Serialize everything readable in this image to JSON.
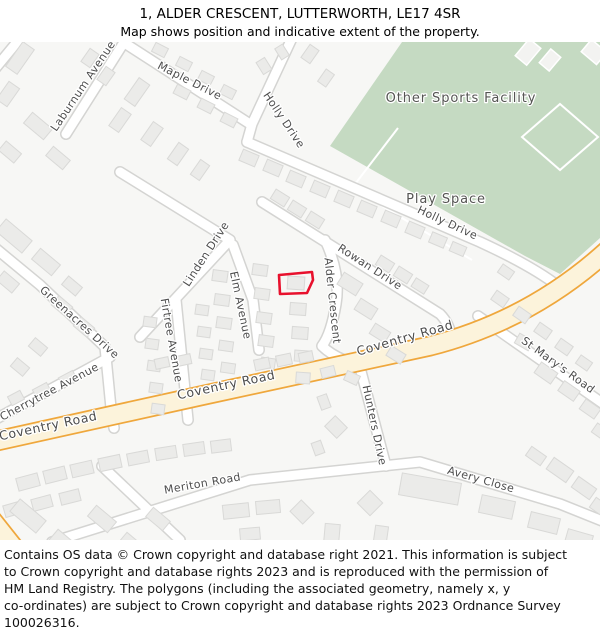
{
  "header": {
    "title": "1, ALDER CRESCENT, LUTTERWORTH, LE17 4SR",
    "subtitle": "Map shows position and indicative extent of the property."
  },
  "map": {
    "area_labels": {
      "sports_facility": "Other Sports Facility",
      "play_space": "Play Space"
    },
    "street_labels": {
      "laburnum": "Laburnum Avenue",
      "maple": "Maple Drive",
      "holly_top": "Holly Drive",
      "holly_se": "Holly Drive",
      "rowan": "Rowan Drive",
      "linden": "Linden Drive",
      "elm": "Elm Avenue",
      "alder": "Alder Crescent",
      "firtree": "Firtree Avenue",
      "greenacres": "Greenacres Drive",
      "cherrytree": "Cherrytree Avenue",
      "coventry_left": "Coventry Road",
      "coventry_mid": "Coventry Road",
      "coventry_right": "Coventry Road",
      "stmarys": "St Mary's Road",
      "hunters": "Hunters Drive",
      "meriton": "Meriton Road",
      "avery": "Avery Close"
    },
    "colors": {
      "background": "#f7f7f5",
      "greenspace": "#c5dac2",
      "building": "#ebebe9",
      "minor_road": "#ffffff",
      "minor_road_casing": "#d4d4d2",
      "primary_road": "#fcf3db",
      "primary_road_casing": "#efa73c",
      "label_text": "#4d4d4d",
      "property_outline": "#e8112d"
    }
  },
  "footer": {
    "lines": [
      "Contains OS data © Crown copyright and database right 2021. This information is subject",
      "to Crown copyright and database rights 2023 and is reproduced with the permission of",
      "HM Land Registry. The polygons (including the associated geometry, namely x, y",
      "co-ordinates) are subject to Crown copyright and database rights 2023 Ordnance Survey",
      "100026316."
    ]
  }
}
